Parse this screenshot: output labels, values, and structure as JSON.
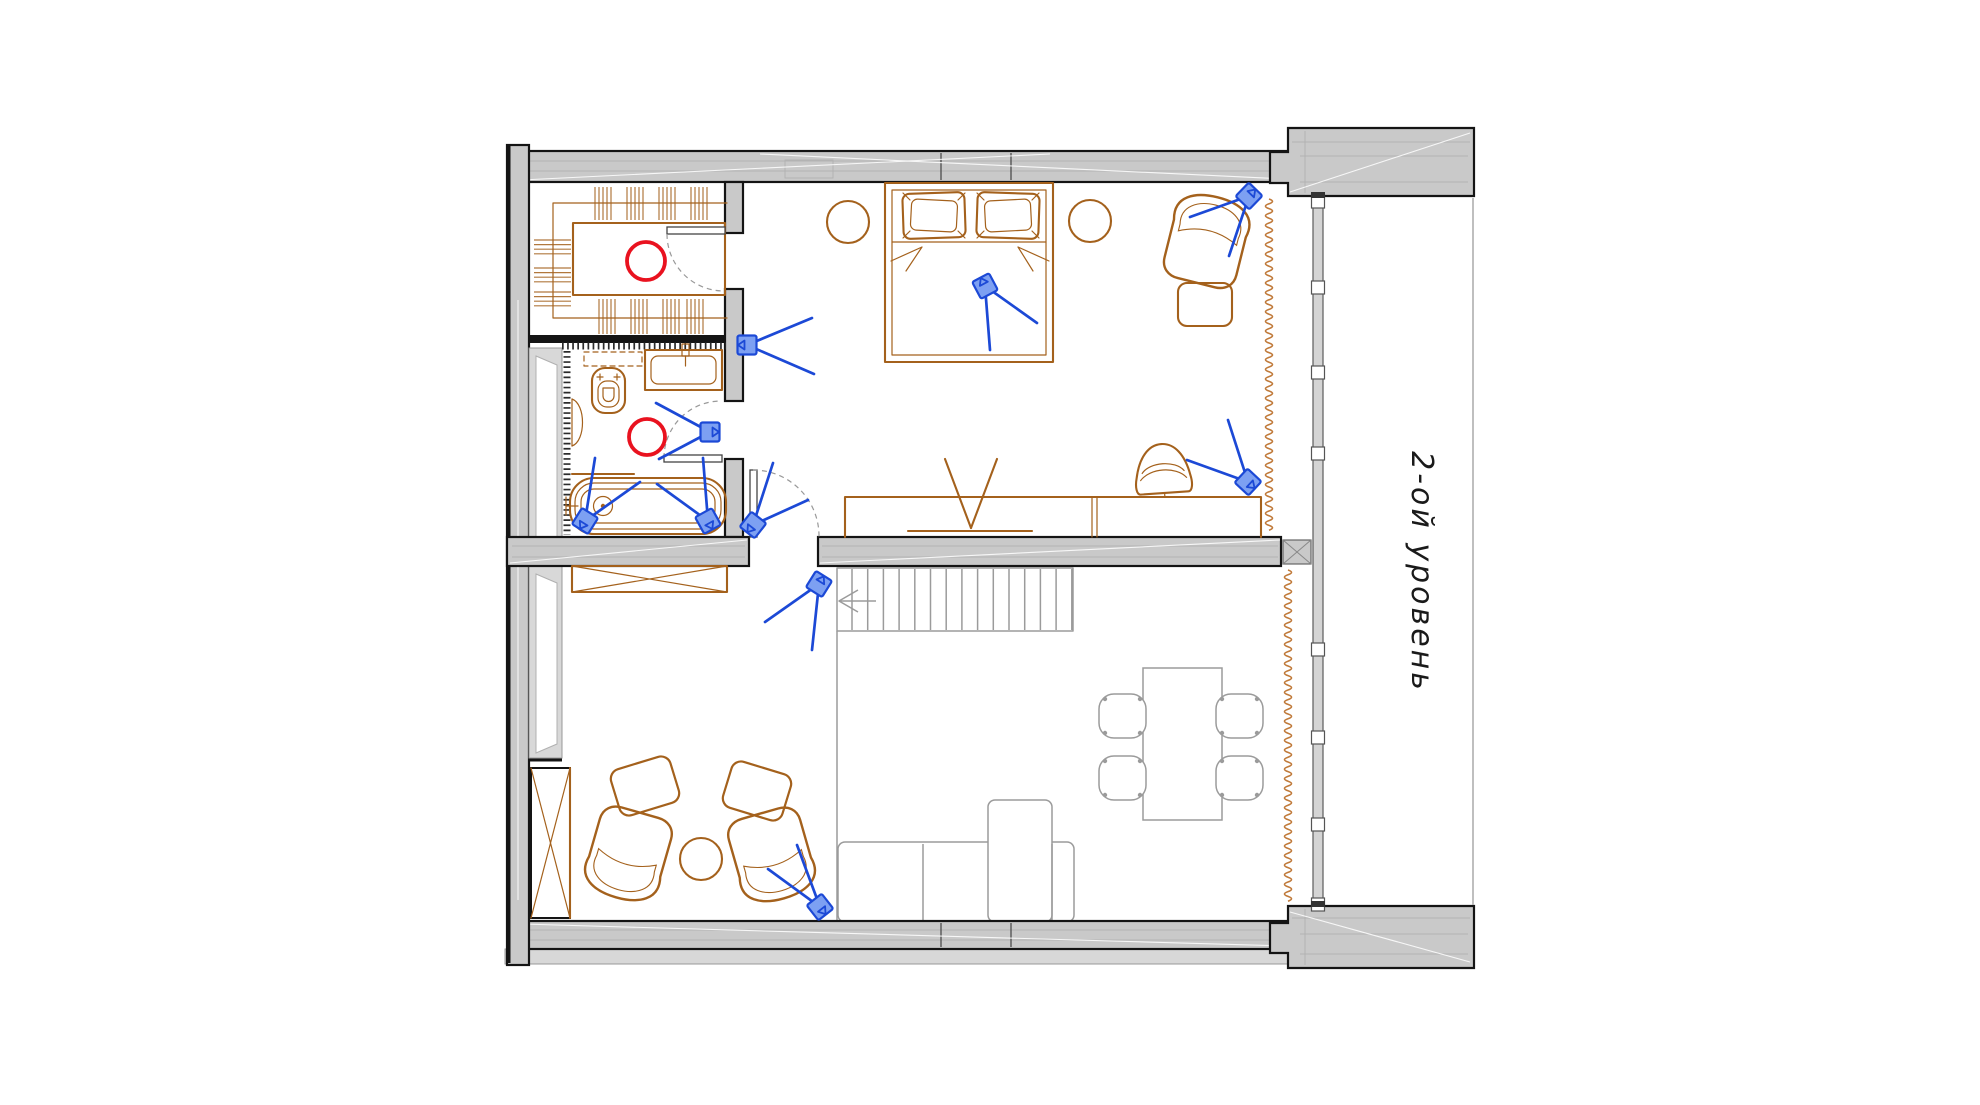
{
  "plan": {
    "level_label": "2-ой уровень"
  },
  "colors": {
    "background": "#ffffff",
    "wall_fill": "#c9c9c9",
    "wall_line": "#141414",
    "wall_inner_line": "#b3b3b3",
    "glass_fill": "#d4d4d4",
    "furniture": "#a4611c",
    "lower_level": "#9b9b9b",
    "camera_stroke": "#1c49d6",
    "camera_fill": "#7da0f2",
    "light_red": "#e9121f",
    "curtain": "#c07a3a",
    "text": "#1a1a1a"
  },
  "devices": {
    "cameras": [
      {
        "x": 747,
        "y": 345,
        "rot": 0,
        "beams": [
          [
            812,
            318
          ],
          [
            814,
            374
          ]
        ]
      },
      {
        "x": 710,
        "y": 432,
        "rot": 180,
        "beams": [
          [
            656,
            403
          ],
          [
            659,
            459
          ]
        ]
      },
      {
        "x": 585,
        "y": 521,
        "rot": -58,
        "beams": [
          [
            640,
            482
          ],
          [
            595,
            458
          ]
        ]
      },
      {
        "x": 708,
        "y": 521,
        "rot": -119,
        "beams": [
          [
            657,
            484
          ],
          [
            703,
            458
          ]
        ]
      },
      {
        "x": 753,
        "y": 525,
        "rot": -52,
        "beams": [
          [
            773,
            463
          ],
          [
            808,
            500
          ]
        ]
      },
      {
        "x": 819,
        "y": 584,
        "rot": 122,
        "beams": [
          [
            765,
            622
          ],
          [
            812,
            650
          ]
        ]
      },
      {
        "x": 985,
        "y": 286,
        "rot": 62,
        "beams": [
          [
            1037,
            323
          ],
          [
            990,
            350
          ]
        ]
      },
      {
        "x": 1249,
        "y": 196,
        "rot": 134,
        "beams": [
          [
            1190,
            217
          ],
          [
            1229,
            256
          ]
        ]
      },
      {
        "x": 1248,
        "y": 482,
        "rot": -137,
        "beams": [
          [
            1187,
            460
          ],
          [
            1228,
            420
          ]
        ]
      },
      {
        "x": 820,
        "y": 907,
        "rot": -128,
        "beams": [
          [
            768,
            869
          ],
          [
            797,
            845
          ]
        ]
      }
    ],
    "ceiling_lights": [
      {
        "x": 646,
        "y": 261,
        "r": 19
      },
      {
        "x": 647,
        "y": 437,
        "r": 18
      }
    ]
  }
}
